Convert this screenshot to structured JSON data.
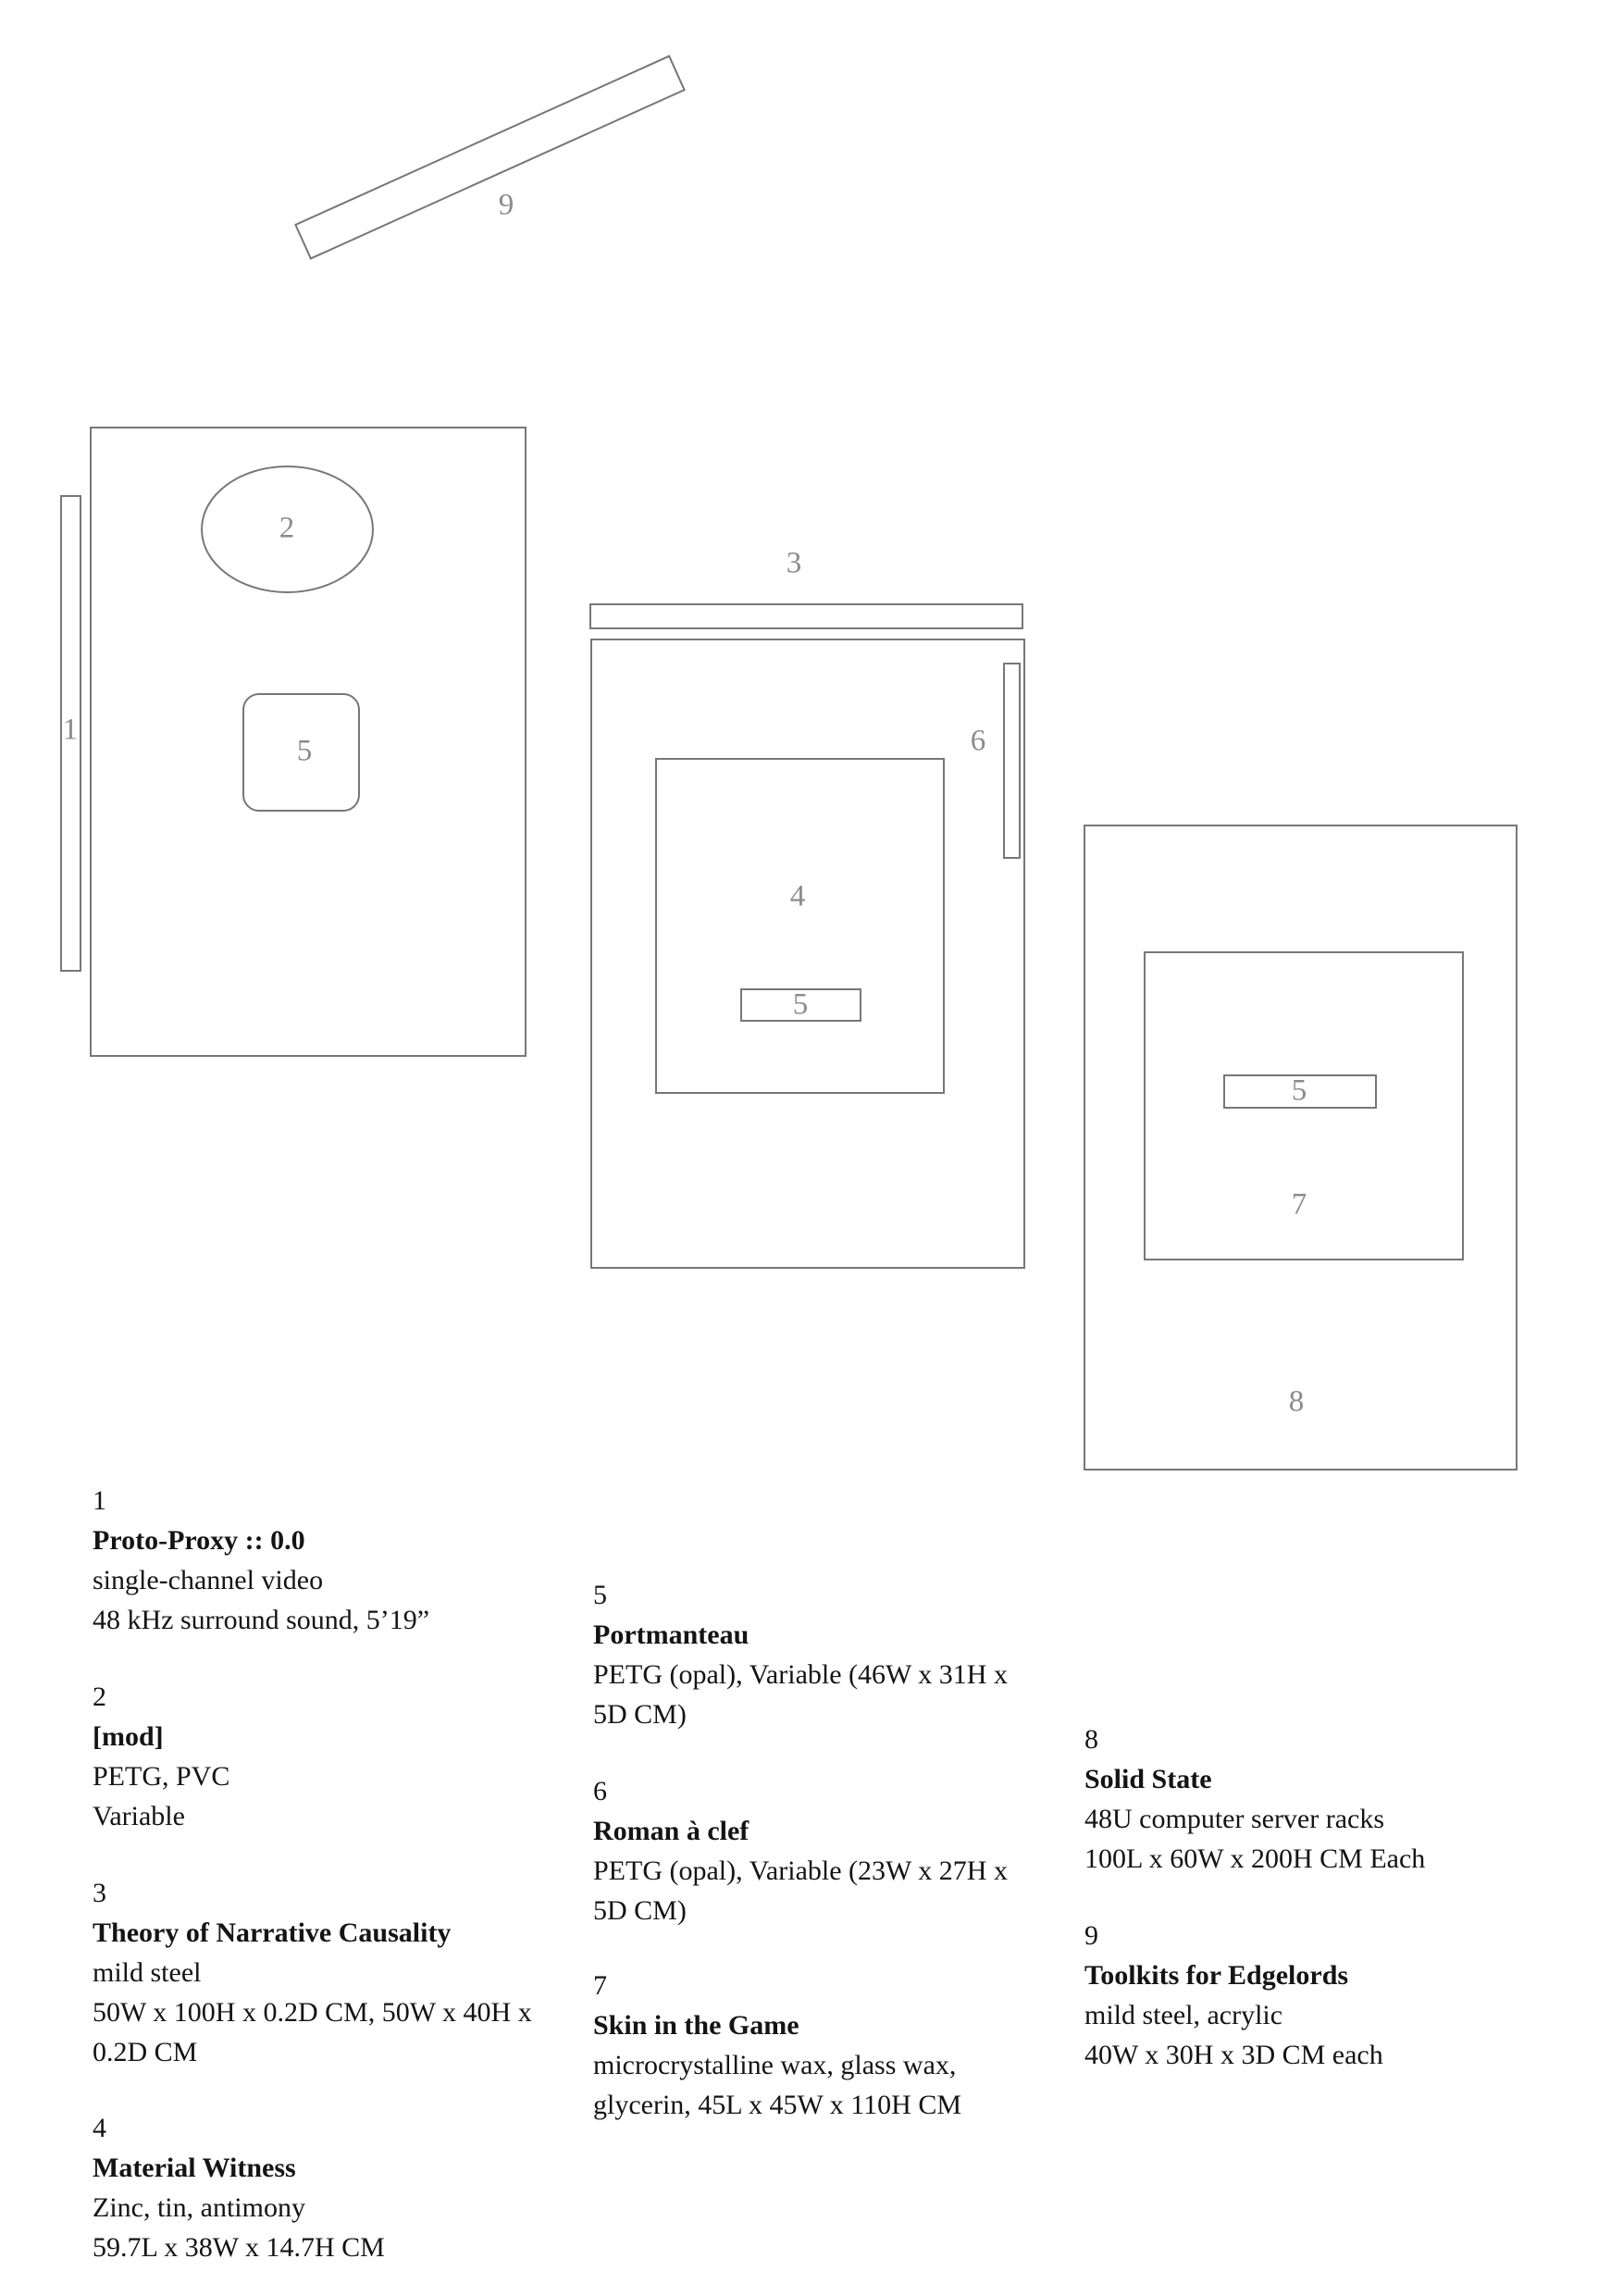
{
  "palette": {
    "background": "#ffffff",
    "shape_stroke": "#777777",
    "plan_label_color": "#8b8b8b",
    "legend_text_color": "#141414"
  },
  "plan": {
    "marker_labels": {
      "video_wall": "1",
      "mod_ellipse": "2",
      "theory_bar": "3",
      "material_witness": "4",
      "portmanteau_left": "5",
      "portmanteau_mid": "5",
      "portmanteau_right": "5",
      "roman_a_clef": "6",
      "skin_in_the_game": "7",
      "solid_state": "8",
      "toolkits": "9"
    }
  },
  "legend": {
    "entries": [
      {
        "number": "1",
        "title": "Proto-Proxy :: 0.0",
        "lines": [
          "single-channel video",
          "48 kHz surround sound, 5’19”"
        ]
      },
      {
        "number": "2",
        "title": "[mod]",
        "lines": [
          "PETG, PVC",
          "Variable"
        ]
      },
      {
        "number": "3",
        "title": "Theory of Narrative Causality",
        "lines": [
          "mild steel",
          "50W x 100H x 0.2D CM, 50W x 40H x",
          "0.2D CM"
        ]
      },
      {
        "number": "4",
        "title": "Material Witness",
        "lines": [
          "Zinc, tin, antimony",
          "59.7L x 38W x 14.7H CM"
        ]
      },
      {
        "number": "5",
        "title": "Portmanteau",
        "lines": [
          "PETG (opal), Variable (46W x 31H x",
          "5D CM)"
        ]
      },
      {
        "number": "6",
        "title": "Roman à clef",
        "lines": [
          "PETG (opal), Variable (23W x 27H x",
          "5D CM)"
        ]
      },
      {
        "number": "7",
        "title": "Skin in the Game",
        "lines": [
          "microcrystalline wax, glass wax,",
          "glycerin, 45L x 45W x 110H CM"
        ]
      },
      {
        "number": "8",
        "title": "Solid State",
        "lines": [
          "48U computer server racks",
          "100L x 60W x 200H CM Each"
        ]
      },
      {
        "number": "9",
        "title": "Toolkits for Edgelords",
        "lines": [
          "mild steel, acrylic",
          "40W x 30H x 3D CM each"
        ]
      }
    ]
  }
}
